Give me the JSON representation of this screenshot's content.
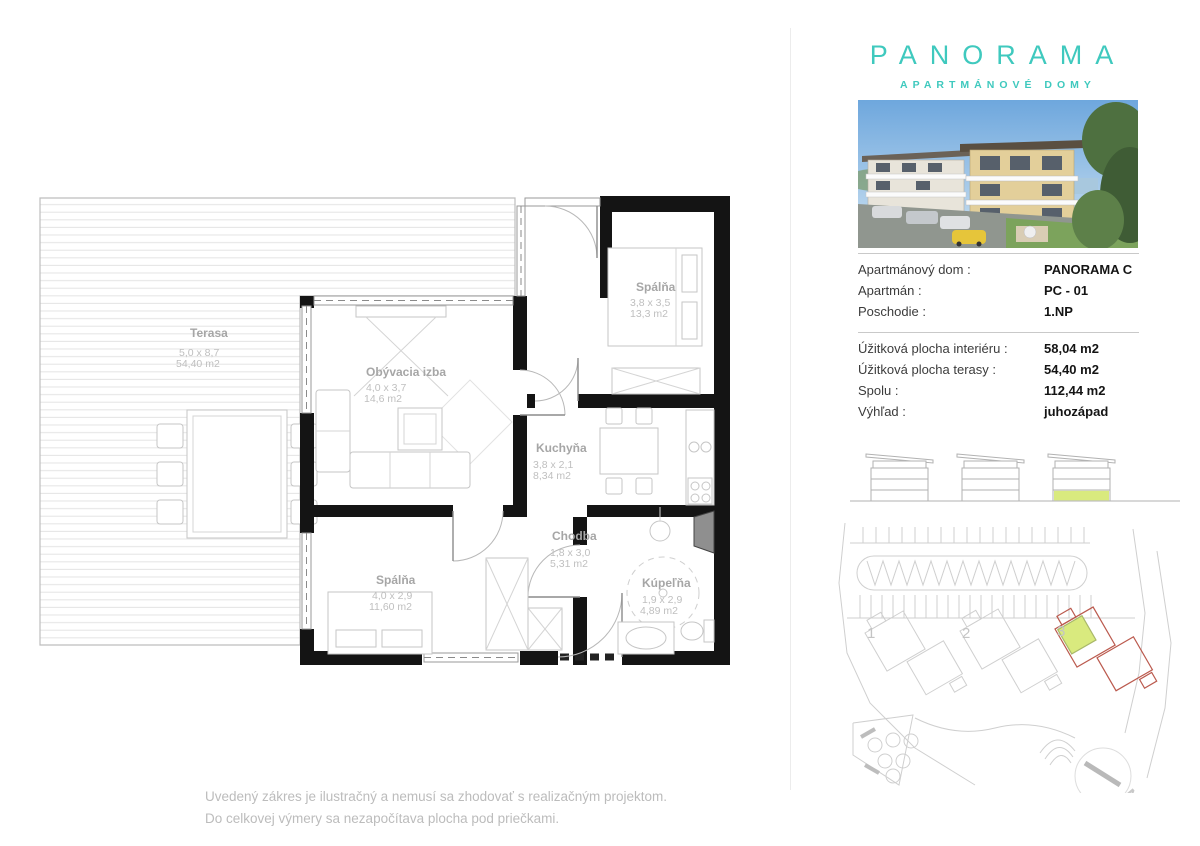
{
  "brand": {
    "title": "PANORAMA",
    "subtitle": "APARTMÁNOVÉ DOMY",
    "accent_color": "#3FC9BE"
  },
  "unit_info": {
    "rows": [
      {
        "label": "Apartmánový dom :",
        "value": "PANORAMA C"
      },
      {
        "label": "Apartmán :",
        "value": "PC - 01"
      },
      {
        "label": "Poschodie :",
        "value": "1.NP"
      }
    ]
  },
  "area_info": {
    "rows": [
      {
        "label": "Úžitková plocha interiéru :",
        "value": "58,04 m2"
      },
      {
        "label": "Úžitková plocha terasy :",
        "value": "54,40 m2"
      },
      {
        "label": "Spolu :",
        "value": "112,44 m2"
      },
      {
        "label": "Výhľad :",
        "value": "juhozápad"
      }
    ]
  },
  "floorplan": {
    "rooms": [
      {
        "name": "Terasa",
        "dims": "5,0 x 8,7",
        "area": "54,40 m2"
      },
      {
        "name": "Obývacia izba",
        "dims": "4,0 x 3,7",
        "area": "14,6 m2"
      },
      {
        "name": "Spálňa",
        "dims": "3,8 x 3,5",
        "area": "13,3 m2"
      },
      {
        "name": "Kuchyňa",
        "dims": "3,8 x 2,1",
        "area": "8,34 m2"
      },
      {
        "name": "Chodba",
        "dims": "1,8 x 3,0",
        "area": "5,31 m2"
      },
      {
        "name": "Kúpeľňa",
        "dims": "1,9 x 2,9",
        "area": "4,89 m2"
      },
      {
        "name": "Spálňa",
        "dims": "4,0 x 2,9",
        "area": "11,60 m2"
      }
    ]
  },
  "site_plan": {
    "labels": [
      "1",
      "2",
      "3"
    ],
    "compass": "N",
    "highlight_color": "#D9EA7E",
    "outline_color": "#BB5A4E"
  },
  "disclaimer": {
    "line1": "Uvedený zákres je ilustračný a nemusí sa zhodovať s realizačným projektom.",
    "line2": "Do celkovej výmery sa nezapočítava plocha pod priečkami."
  }
}
